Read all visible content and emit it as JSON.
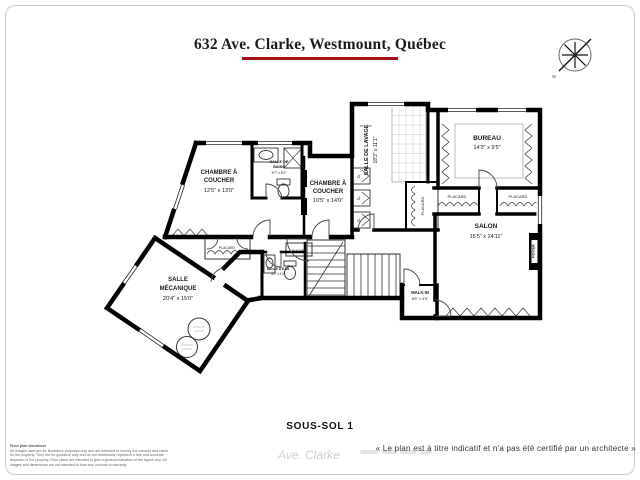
{
  "header": {
    "title": "632 Ave. Clarke, Westmount, Québec"
  },
  "compass": {
    "north_label": "N"
  },
  "rooms": {
    "chambre1": {
      "name_line1": "CHAMBRE À",
      "name_line2": "COUCHER",
      "dims": "12'5\" x 13'0\""
    },
    "chambre2": {
      "name_line1": "CHAMBRE À",
      "name_line2": "COUCHER",
      "dims": "10'5\" x 14'0\""
    },
    "salle_de_bains": {
      "name_line1": "SALLE DE",
      "name_line2": "BAINS",
      "dims": "5'7\" x 8'3\""
    },
    "salle_de_lavage": {
      "name": "SALLE DE LAVAGE",
      "dims": "18'3\" x 11'1\""
    },
    "bureau": {
      "name": "BUREAU",
      "dims": "14'3\" x 9'5\""
    },
    "salon": {
      "name": "SALON",
      "dims": "15'5\" x 24'11\""
    },
    "salle_mecanique": {
      "name_line1": "SALLE",
      "name_line2": "MÉCANIQUE",
      "dims": "20'4\" x 15'0\""
    },
    "walk_in": {
      "name": "WALK-IN",
      "dims": "6'5\" x 4'5\""
    },
    "salle_d_eau": {
      "name": "SALLE D'EAU",
      "dims": "5'2\" x 4'5\""
    },
    "foyer": {
      "name": "FOYER"
    },
    "placards": {
      "laundry": "PLACARD",
      "bureau_left": "PLACARD",
      "bureau_right": "PLACARD",
      "hall": "PLACARD",
      "stairs": "PLACARD"
    },
    "duct_label": "d",
    "small_dim": "4'1\" x 1'0\""
  },
  "footer": {
    "floor_label": "SOUS-SOL 1",
    "certification_note": "« Le plan est à titre indicatif et n'a pas été certifié par un architecte »",
    "watermark": "Ave. Clarke",
    "disclaimer_title": "Floor plan disclaimer",
    "disclaimer_lines": [
      "All images used are for illustrative purposes only and are intended to convey the concept and vision",
      "for the property. They are for guidance only and do not necessarily represent a true and accurate",
      "depiction of the property. Floor plans are intended to give a general indication of the layout only. All",
      "images and dimensions are not intended to form any contract or warranty."
    ]
  }
}
